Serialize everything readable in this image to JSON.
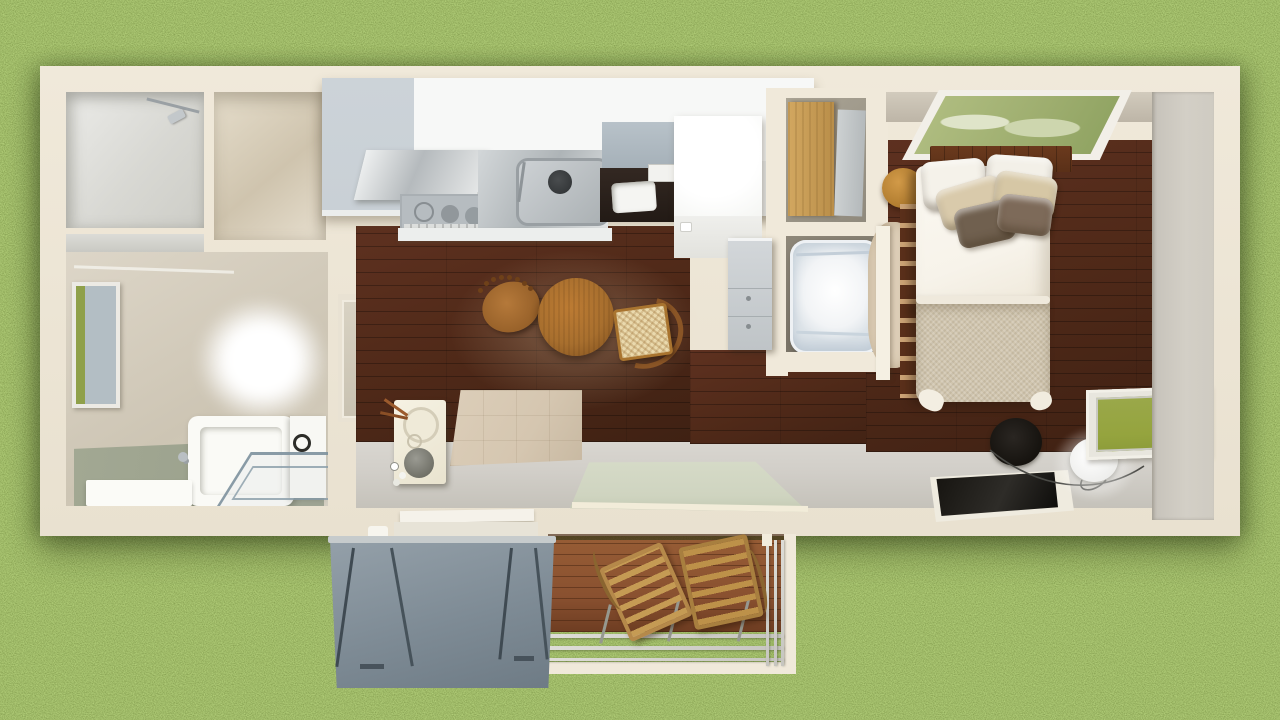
{
  "scene": {
    "description": "Overhead photorealistic 3D render of a rectangular tiny-house floor plan set on a grass lawn, with an attached wooden deck, gray awning canopy and metal railing at the bottom",
    "view": "top-down",
    "no_visible_text": true
  },
  "palette": {
    "grassBase": "#7d9a42",
    "wallOuter": "#f0e9da",
    "innerBeige": "#d6cebe",
    "roomGray": "#dededa",
    "woodFloor": "#512a19",
    "deckWood": "#8a5130",
    "cabinetWhite": "#f7f8f7",
    "cabinetGray": "#c9d0d6",
    "steel": "#c2c7ca",
    "fridgeWhite": "#fefefc",
    "bathFloor": "#989e8a",
    "tileBeige": "#d5c6b0",
    "tatami": "#cfd4c0",
    "awningGray": "#7e8b95",
    "bedSheet": "#f7f3ea",
    "bedBlanket": "#d0c5ae",
    "headboard": "#5a3018",
    "pillowBeige": "#d9caab",
    "pillowBrown": "#70604f",
    "oakWood": "#c89a55",
    "tableWood": "#a86f2e",
    "skylightGreen": "#9dad6e",
    "windowGreen": "#95a43e",
    "eastWall": "#d3cfc6",
    "southWall": "#d2cfc9"
  },
  "regions": {
    "storage_room": {
      "items": [
        "ceiling-fixture"
      ]
    },
    "closet_room": {
      "items": []
    },
    "bathroom": {
      "items": [
        "west-window",
        "frosted-window-glow",
        "bathtub",
        "bench",
        "glass-shower",
        "vanity"
      ]
    },
    "utility": {
      "items": [
        "washing-machine",
        "tile-entry"
      ]
    },
    "kitchen": {
      "items": [
        "upper-cabinet-block",
        "range-hood",
        "cooktop",
        "stainless-counter",
        "sink",
        "desk-nook",
        "refrigerator"
      ]
    },
    "dining": {
      "items": [
        "round-table",
        "windsor-chair",
        "wishbone-chair"
      ]
    },
    "nook": {
      "items": [
        "wardrobe",
        "sliding-panel",
        "white-armchair",
        "gray-cabinet"
      ]
    },
    "bedroom": {
      "items": [
        "skylight",
        "stool",
        "rug",
        "ladder-slats",
        "bed",
        "pillows",
        "black-basket",
        "tv-panel",
        "floor-lamp",
        "south-window"
      ]
    },
    "outdoor": {
      "items": [
        "deck",
        "folding-chair-left",
        "folding-chair-right",
        "railing",
        "awning-panel",
        "awning-legs",
        "tatami-platform"
      ]
    }
  }
}
